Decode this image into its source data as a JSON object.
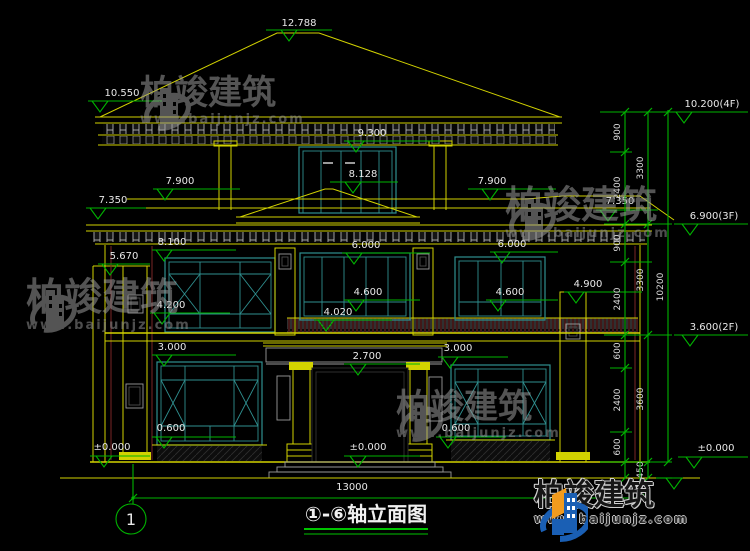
{
  "drawing": {
    "title": "①-⑥轴立面图",
    "axis_bubble": "1",
    "total_width": "13000"
  },
  "elev": {
    "e12788": "12.788",
    "e10550": "10.550",
    "e9300": "9.300",
    "e8128": "8.128",
    "e7900l": "7.900",
    "e7900r": "7.900",
    "e7350l": "7.350",
    "e7350r": "7.350",
    "e8100": "8.100",
    "e6000c": "6.000",
    "e6000r": "6.000",
    "e5670": "5.670",
    "e4600l": "4.600",
    "e4600r": "4.600",
    "e4900": "4.900",
    "e4200": "4.200",
    "e4020": "4.020",
    "e3000l": "3.000",
    "e3000r": "3.000",
    "e2700": "2.700",
    "e0600l": "0.600",
    "e0600r": "0.600",
    "e0000l": "±0.000",
    "e0000c": "±0.000"
  },
  "right_levels": {
    "f4": "10.200(4F)",
    "f3": "6.900(3F)",
    "f2": "3.600(2F)",
    "f0": "±0.000"
  },
  "chain": {
    "segments": [
      "900",
      "2400",
      "900",
      "2400",
      "600",
      "2400",
      "600",
      "450"
    ],
    "subtotals": [
      "3300",
      "3300",
      "3600"
    ],
    "total": "10200"
  },
  "watermark": {
    "brand": "柏竣建筑",
    "url": "www.baijunjz.com"
  },
  "footer_logo": {
    "brand": "柏竣建筑",
    "url": "www.baijunjz.com"
  },
  "colors": {
    "background": "#000000",
    "line_yellow": "#d2d200",
    "dim_green": "#00b400",
    "window_teal": "#2f8f8f",
    "wall_maroon": "#7a2626",
    "text_white": "#e8e8e8",
    "logo_blue": "#1a5fb4",
    "logo_orange": "#f29b1d"
  }
}
